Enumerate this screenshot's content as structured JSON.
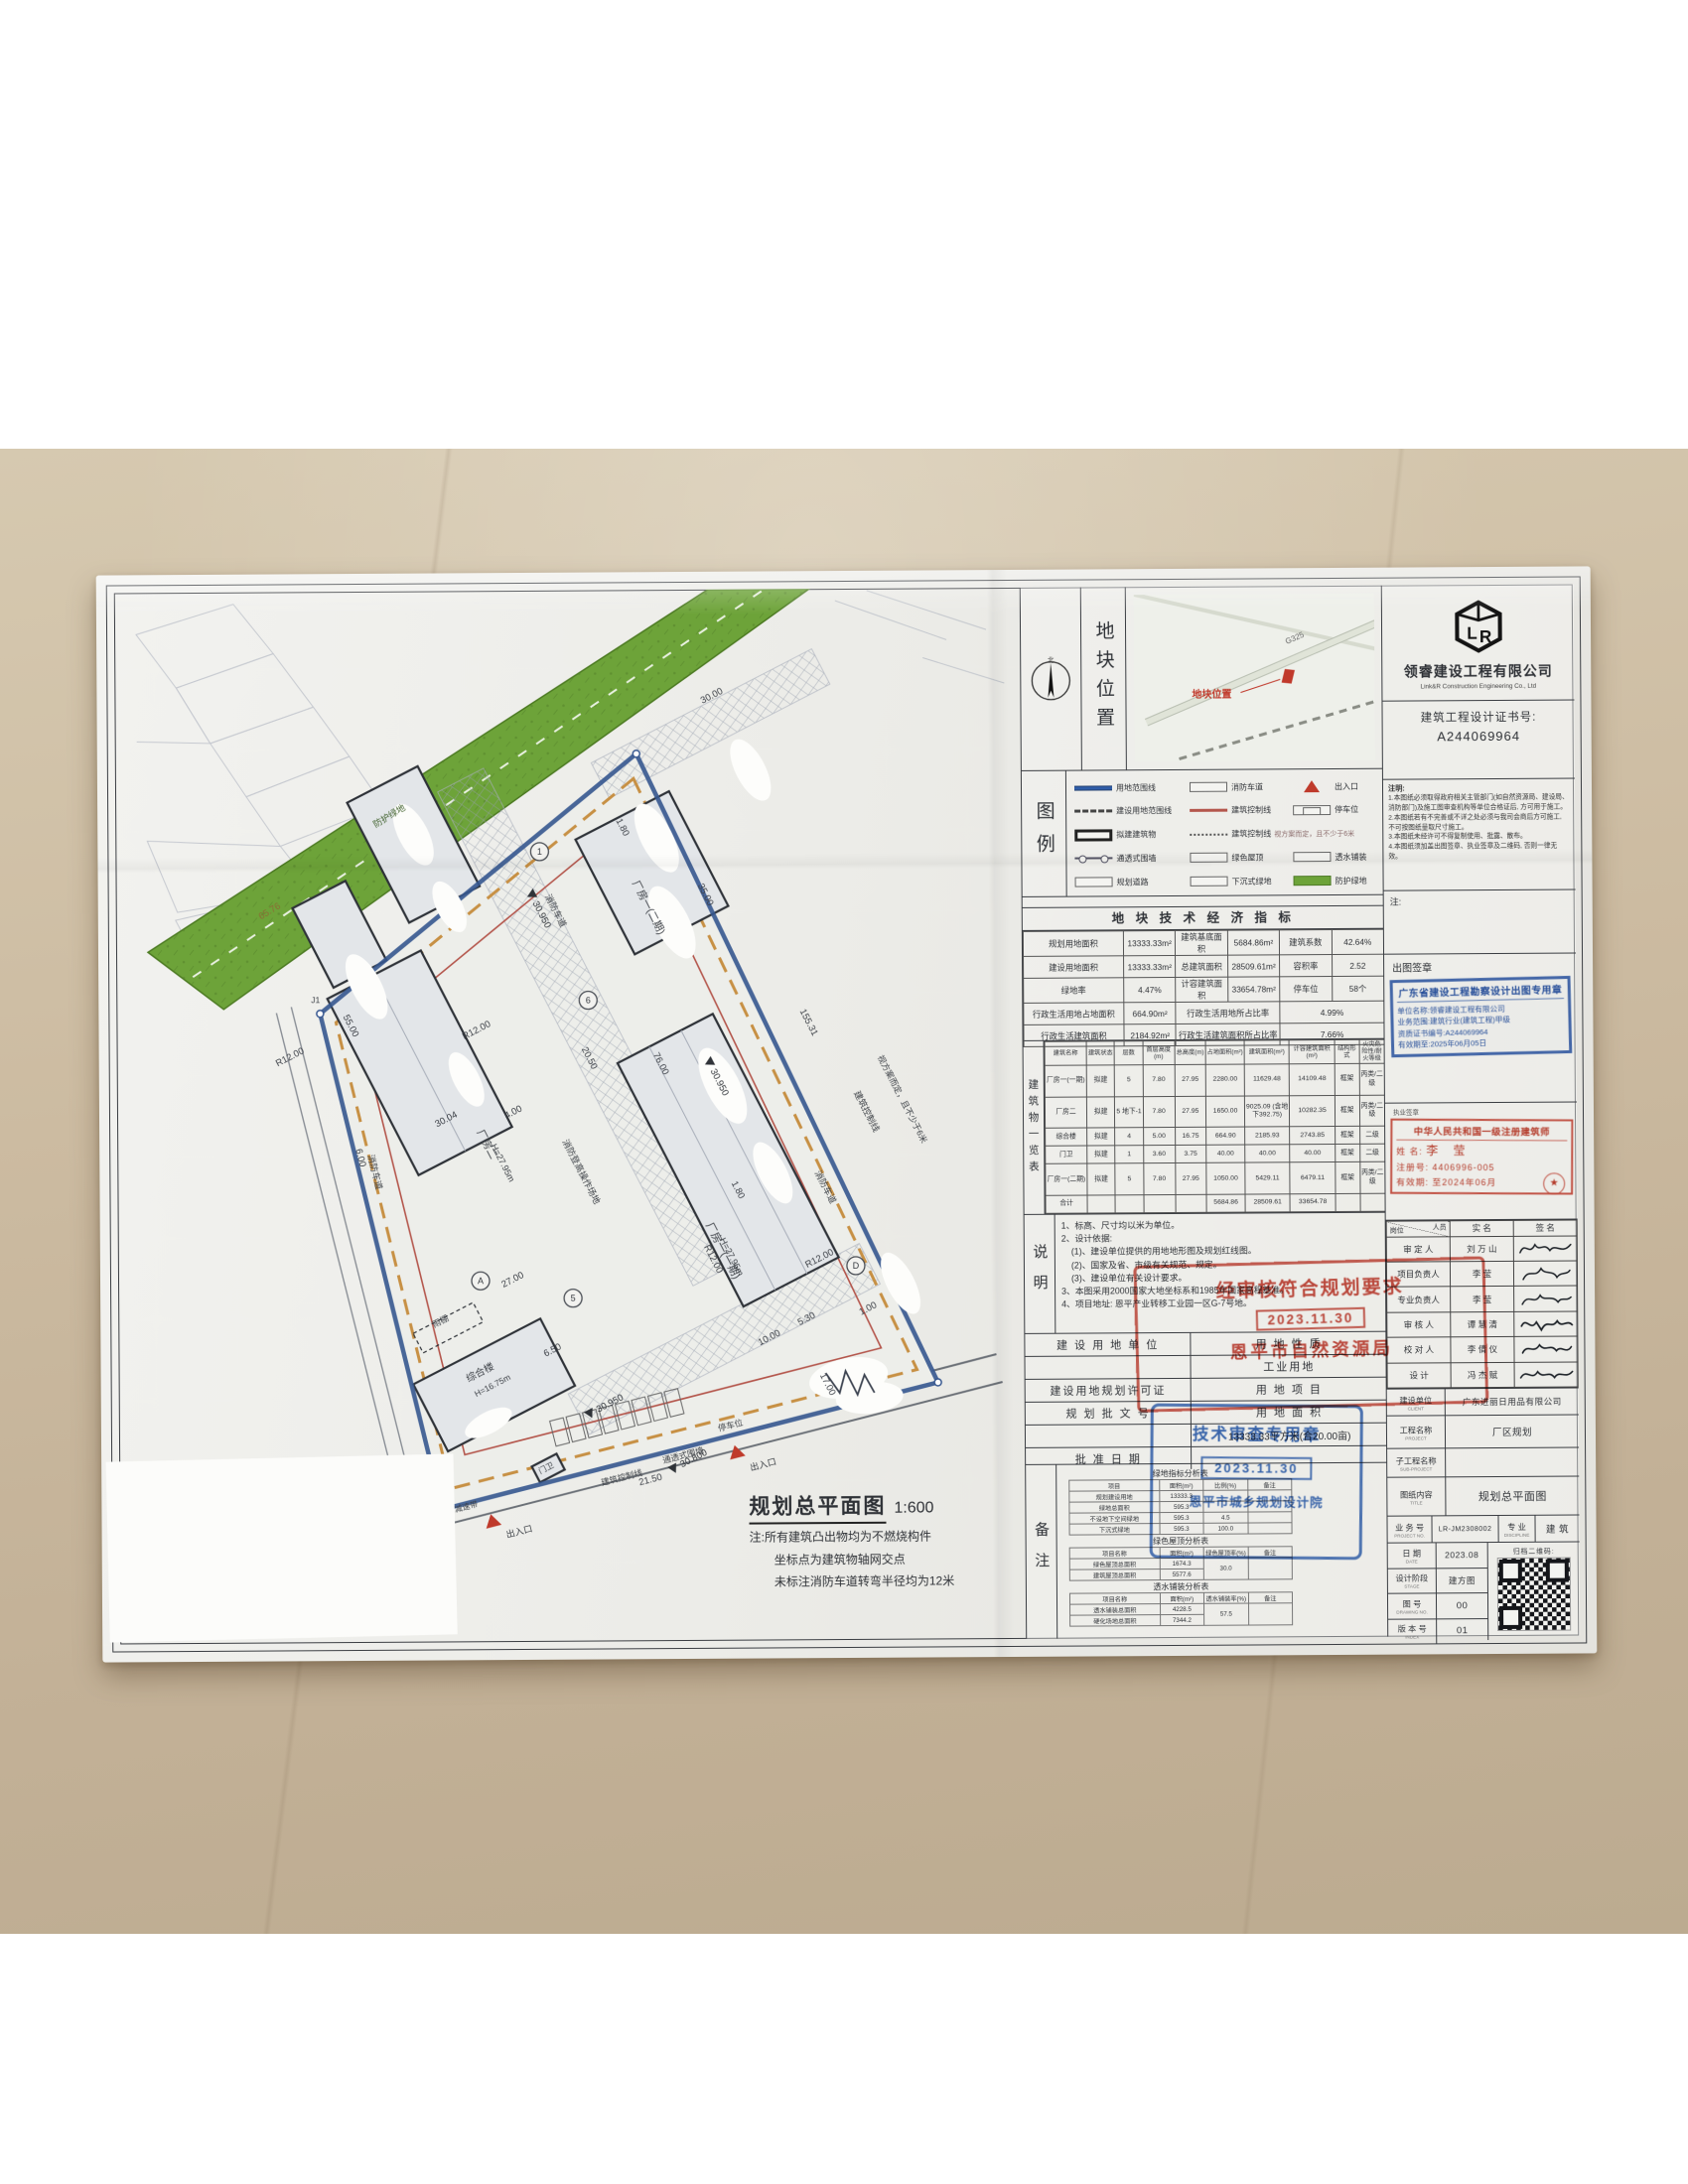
{
  "colors": {
    "floor": "#c9b89e",
    "paper": "#ececе8",
    "boundary_blue": "#35568f",
    "buffer_green": "#6da339",
    "stamp_red": "#c23a2c",
    "stamp_blue": "#2d5fae",
    "control_orange": "#c79044",
    "entrance_red": "#bf3a2b"
  },
  "company": {
    "name": "领睿建设工程有限公司",
    "name_en": "Link&R Construction Engineering Co., Ltd",
    "cert_label": "建筑工程设计证书号:",
    "cert_no": "A244069964",
    "logo_text": "LR"
  },
  "location": {
    "panel_label": "地块位置",
    "north": "北",
    "highway": "G325",
    "marker_label": "地块位置"
  },
  "legend": {
    "panel_label": "图例",
    "r1c1": "用地范围线",
    "r1c2": "消防车道",
    "r1c3": "出入口",
    "r2c1": "建设用地范围线",
    "r2c2": "建筑控制线",
    "r2c3": "停车位",
    "r3c1": "拟建建筑物",
    "r3c2": "建筑控制线",
    "r3c2b": "视方案而定，且不少于6米",
    "r4c1": "通透式围墙",
    "r4c2": "绿色屋顶",
    "r4c3": "透水铺装",
    "r5c1": "规划道路",
    "r5c2": "下沉式绿地",
    "r5c3": "防护绿地"
  },
  "indicators": {
    "title": "地 块  技 术 经 济 指 标",
    "rows": [
      [
        "规划用地面积",
        "13333.33m²",
        "建筑基底面积",
        "5684.86m²",
        "建筑系数",
        "42.64%"
      ],
      [
        "建设用地面积",
        "13333.33m²",
        "总建筑面积",
        "28509.61m²",
        "容积率",
        "2.52"
      ],
      [
        "绿地率",
        "4.47%",
        "计容建筑面积",
        "33654.78m²",
        "停车位",
        "58个"
      ],
      [
        "行政生活用地占地面积",
        "664.90m²",
        {
          "t": "行政生活用地所占比率",
          "c": 2
        },
        {
          "t": "4.99%",
          "c": 2
        }
      ],
      [
        "行政生活建筑面积",
        "2184.92m²",
        {
          "t": "行政生活建筑面积所占比率",
          "c": 2
        },
        {
          "t": "7.66%",
          "c": 2
        }
      ]
    ]
  },
  "buildings": {
    "side_label": "建筑物一览表",
    "head": [
      "建筑名称",
      "建筑状态",
      "层数",
      "首层高度(m)",
      "总高度(m)",
      "占地面积(m²)",
      "建筑面积(m²)",
      "计容建筑面积(m²)",
      "结构形式",
      "火灾危险性/耐火等级"
    ],
    "rows": [
      [
        "厂房一(一期)",
        "拟建",
        "5",
        "7.80",
        "27.95",
        "2280.00",
        "11629.48",
        "14109.48",
        "框架",
        "丙类/二级"
      ],
      [
        "厂房二",
        "拟建",
        "5 地下-1",
        "7.80",
        "27.95",
        "1650.00",
        "9025.09 (含地下392.75)",
        "10282.35",
        "框架",
        "丙类/二级"
      ],
      [
        "综合楼",
        "拟建",
        "4",
        "5.00",
        "16.75",
        "664.90",
        "2185.93",
        "2743.85",
        "框架",
        "二级"
      ],
      [
        "门卫",
        "拟建",
        "1",
        "3.60",
        "3.75",
        "40.00",
        "40.00",
        "40.00",
        "框架",
        "二级"
      ],
      [
        "厂房一(二期)",
        "拟建",
        "5",
        "7.80",
        "27.95",
        "1050.00",
        "5429.11",
        "6479.11",
        "框架",
        "丙类/二级"
      ],
      [
        "合计",
        "",
        "",
        "",
        "",
        "5684.86",
        "28509.61",
        "33654.78",
        "",
        ""
      ]
    ]
  },
  "notes": {
    "side_label": "说明",
    "lines": [
      "1、标高、尺寸均以米为单位。",
      "2、设计依据:",
      "(1)、建设单位提供的用地地形图及规划红线图。",
      "(2)、国家及省、市级有关规范、规定。",
      "(3)、建设单位有关设计要求。",
      "3、本图采用2000国家大地坐标系和1985年国家高程基准。",
      "4、项目地址: 恩平产业转移工业园一区G-7号地。"
    ]
  },
  "approval": {
    "land_unit": "建 设 用 地 单 位",
    "land_nature": "用 地 性 质",
    "industrial": "工业用地",
    "permit": "建设用地规划许可证",
    "land_project": "用 地 项 目",
    "plan_doc_no": "规 划 批 文 号",
    "land_area": "用 地 面 积",
    "land_area_value": "13333.33平方米(合20.00亩)",
    "approve_date": "批 准 日 期"
  },
  "stamps": {
    "review": {
      "line1": "经审核符合规划要求",
      "date": "2023.11.30",
      "org": "恩平市自然资源局"
    },
    "tech": {
      "title": "技术审查专用章",
      "date": "2023.11.30",
      "org": "恩平市城乡规划设计院"
    },
    "chutu": {
      "title": "广东省建设工程勘察设计出图专用章",
      "unit": "单位名称:领睿建设工程有限公司",
      "scope": "业务范围:建筑行业(建筑工程)甲级",
      "cert": "资质证书编号:A244069964",
      "valid": "有效期至:2025年06月05日"
    },
    "architect": {
      "title": "中华人民共和国一级注册建筑师",
      "name_label": "姓 名:",
      "name": "李 莹",
      "reg_label": "注册号:",
      "reg": "4406996-005",
      "valid_label": "有效期:",
      "valid": "至2024年06月"
    }
  },
  "remark": {
    "side_label": "备注",
    "green_table": {
      "title": "绿地指标分析表",
      "head": [
        "项目",
        "面积(m²)",
        "比例(%)",
        "备注"
      ],
      "rows": [
        [
          "规划建设用地",
          "13333.3",
          "",
          ""
        ],
        [
          "绿地总面积",
          "595.3",
          "",
          ""
        ],
        [
          "不设地下空间绿地",
          "595.3",
          "4.5",
          ""
        ],
        [
          "下沉式绿地",
          "595.3",
          "100.0",
          ""
        ]
      ]
    },
    "roof_table": {
      "title": "绿色屋顶分析表",
      "head": [
        "项目名称",
        "面积(m²)",
        "绿色屋顶率(%)",
        "备注"
      ],
      "rows": [
        [
          "绿色屋顶总面积",
          "1674.3",
          {
            "t": "30.0",
            "r": 2
          },
          {
            "t": "",
            "r": 2
          }
        ],
        [
          "建筑屋顶总面积",
          "5577.6"
        ]
      ]
    },
    "perm_table": {
      "title": "透水铺装分析表",
      "head": [
        "项目名称",
        "面积(m²)",
        "透水铺装率(%)",
        "备注"
      ],
      "rows": [
        [
          "透水铺装总面积",
          "4228.5",
          {
            "t": "57.5",
            "r": 2
          },
          {
            "t": "",
            "r": 2
          }
        ],
        [
          "硬化场地总面积",
          "7344.2"
        ]
      ]
    }
  },
  "instructions": {
    "title": "注明:",
    "items": [
      "1.本图纸必须取得政府相关主管部门(如自然资源局、建设局、消防部门)及施工图审查机构等单位合格证后, 方可用于施工。",
      "2.本图纸若有不完善或不详之处必须与我司会商后方可施工, 不可按图纸量取尺寸施工。",
      "3.本图纸未经许可不得复制使用、批露、散布。",
      "4.本图纸须加盖出图签章、执业签章及二维码, 否则一律无效。"
    ],
    "note_label": "注:"
  },
  "sign_off": {
    "chutu_label": "出图签章",
    "zhiye_label": "执业签章"
  },
  "sign_table": {
    "pos": "岗位",
    "per": "人员",
    "name_h": "实 名",
    "sig_h": "签 名",
    "rows": [
      [
        "审 定 人",
        "刘 万 山"
      ],
      [
        "项目负责人",
        "李 莹"
      ],
      [
        "专业负责人",
        "李 莹"
      ],
      [
        "审 核 人",
        "谭 慧 清"
      ],
      [
        "校 对 人",
        "李 倩 仪"
      ],
      [
        "设 计",
        "冯 杰 赋"
      ]
    ]
  },
  "title_block": {
    "client_label": "建设单位",
    "client_en": "CLIENT",
    "client": "广东进丽日用品有限公司",
    "project_label": "工程名称",
    "project_en": "PROJECT",
    "project": "厂区规划",
    "sub_label": "子工程名称",
    "sub_en": "SUB-PROJECT",
    "sub": "",
    "title_label": "图纸内容",
    "title_en": "TITLE",
    "title": "规划总平面图",
    "no_label": "业 务 号",
    "no_en": "PROJECT NO.",
    "no": "LR-JM2308002",
    "disc_label": "专 业",
    "disc_en": "DISCIPLINE",
    "disc": "建 筑",
    "date_label": "日 期",
    "date_en": "DATE",
    "date": "2023.08",
    "qr_label": "归档二维码:",
    "stage_label": "设计阶段",
    "stage_en": "STAGE",
    "stage": "建方图",
    "dwg_label": "图 号",
    "dwg_en": "DRAWING NO.",
    "dwg": "00",
    "index_label": "版 本 号",
    "index_en": "INDEX",
    "index": "01"
  },
  "drawing": {
    "title": "规划总平面图",
    "scale": "1:600",
    "notes": [
      "注:所有建筑凸出物均为不燃烧构件",
      "坐标点为建筑物轴网交点",
      "未标注消防车道转弯半径均为12米"
    ],
    "labels": {
      "factory1_p1": "厂房一(一期)",
      "factory1_p1_h": "H=27.95m",
      "factory1_p2": "厂房一(二期)",
      "factory2": "厂房二",
      "factory2_h": "H=27.95m",
      "complex": "综合楼",
      "complex_h": "H=16.75m",
      "canopy": "雨棚",
      "gatehouse": "门卫",
      "fire_lane": "消防车道",
      "fire_ops": "消防登高操作场地",
      "ctrl_line": "建筑控制线",
      "fence": "通透式围墙",
      "parking": "停车位",
      "entrance": "出入口",
      "speed_bump": "减速带",
      "green_buffer": "防护绿地",
      "per_plan": "视方案而定，且不少于6米",
      "j4": "J4",
      "j1": "J1",
      "levels": {
        "a": "30.950",
        "b": "30.800"
      },
      "dims": {
        "d3000": "30.00",
        "d3500": "35.00",
        "d7600": "76.00",
        "d5500": "55.00",
        "d3004": "30.04",
        "d2700": "27.00",
        "d15531": "155.31",
        "d2050": "20.50",
        "d1700": "17.00",
        "d1000": "10.00",
        "d650": "6.50",
        "d600": "6.00",
        "d530": "5.30",
        "d400": "4.00",
        "d180": "1.80",
        "d100": "1.00",
        "d2150": "21.50",
        "d6576": "65.76",
        "r12": "R12.00"
      },
      "axis": {
        "a1": "1",
        "a5": "5",
        "a6": "6",
        "aA": "A",
        "aD": "D"
      }
    }
  }
}
